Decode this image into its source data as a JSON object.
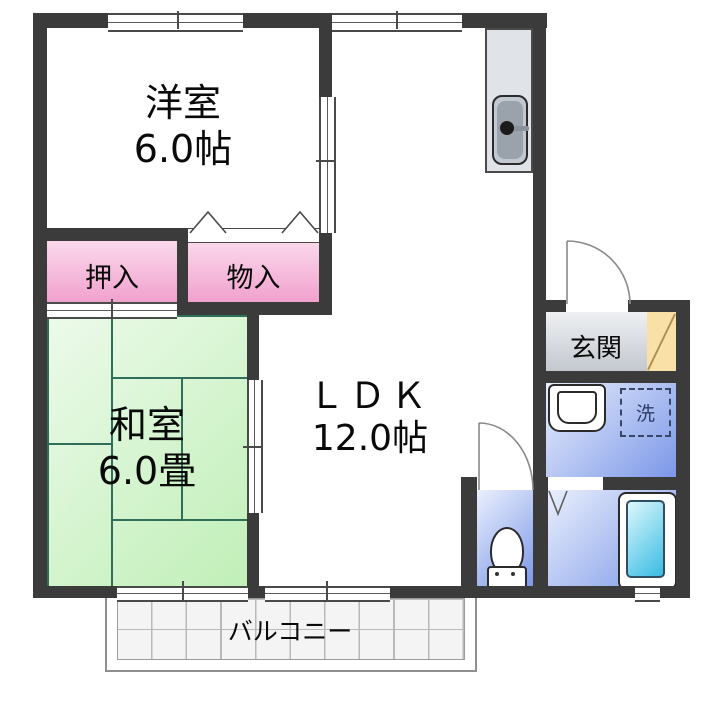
{
  "plan": {
    "title": "2LDK apartment floor plan",
    "rooms": {
      "western_room": {
        "label": "洋室",
        "size": "6.0帖"
      },
      "japanese_room": {
        "label": "和室",
        "size": "6.0畳"
      },
      "ldk": {
        "label": "ＬＤＫ",
        "size": "12.0帖"
      },
      "oshiire_closet": {
        "label": "押入"
      },
      "monoire_closet": {
        "label": "物入"
      },
      "entrance": {
        "label": "玄関"
      },
      "laundry_space": {
        "label": "洗"
      },
      "balcony": {
        "label": "バルコニー"
      }
    },
    "fixtures": [
      "kitchen-sink",
      "washbasin",
      "toilet",
      "bathtub",
      "washing-machine-space",
      "shoe-cabinet",
      "entrance-door",
      "toilet-door",
      "folding-closet-doors",
      "sliding-doors",
      "windows"
    ],
    "colors": {
      "wall": "#3b3b3b",
      "closet_pink_light": "#fbd9ec",
      "closet_pink": "#f0a0cd",
      "tatami_green_light": "#ecfaea",
      "tatami_green": "#c0efb7",
      "tatami_line": "#2f6e5a",
      "wet_blue_light": "#e9effc",
      "wet_blue": "#7b97e8",
      "bathtub_cyan": "#38bce4",
      "genkan_gray_light": "#eef0f2",
      "genkan_gray": "#c3c8cf",
      "shoe_cabinet_yellow": "#f9e0a6",
      "balcony_tile": "#f4f4f4",
      "counter_gray": "#e0e4e8"
    }
  }
}
